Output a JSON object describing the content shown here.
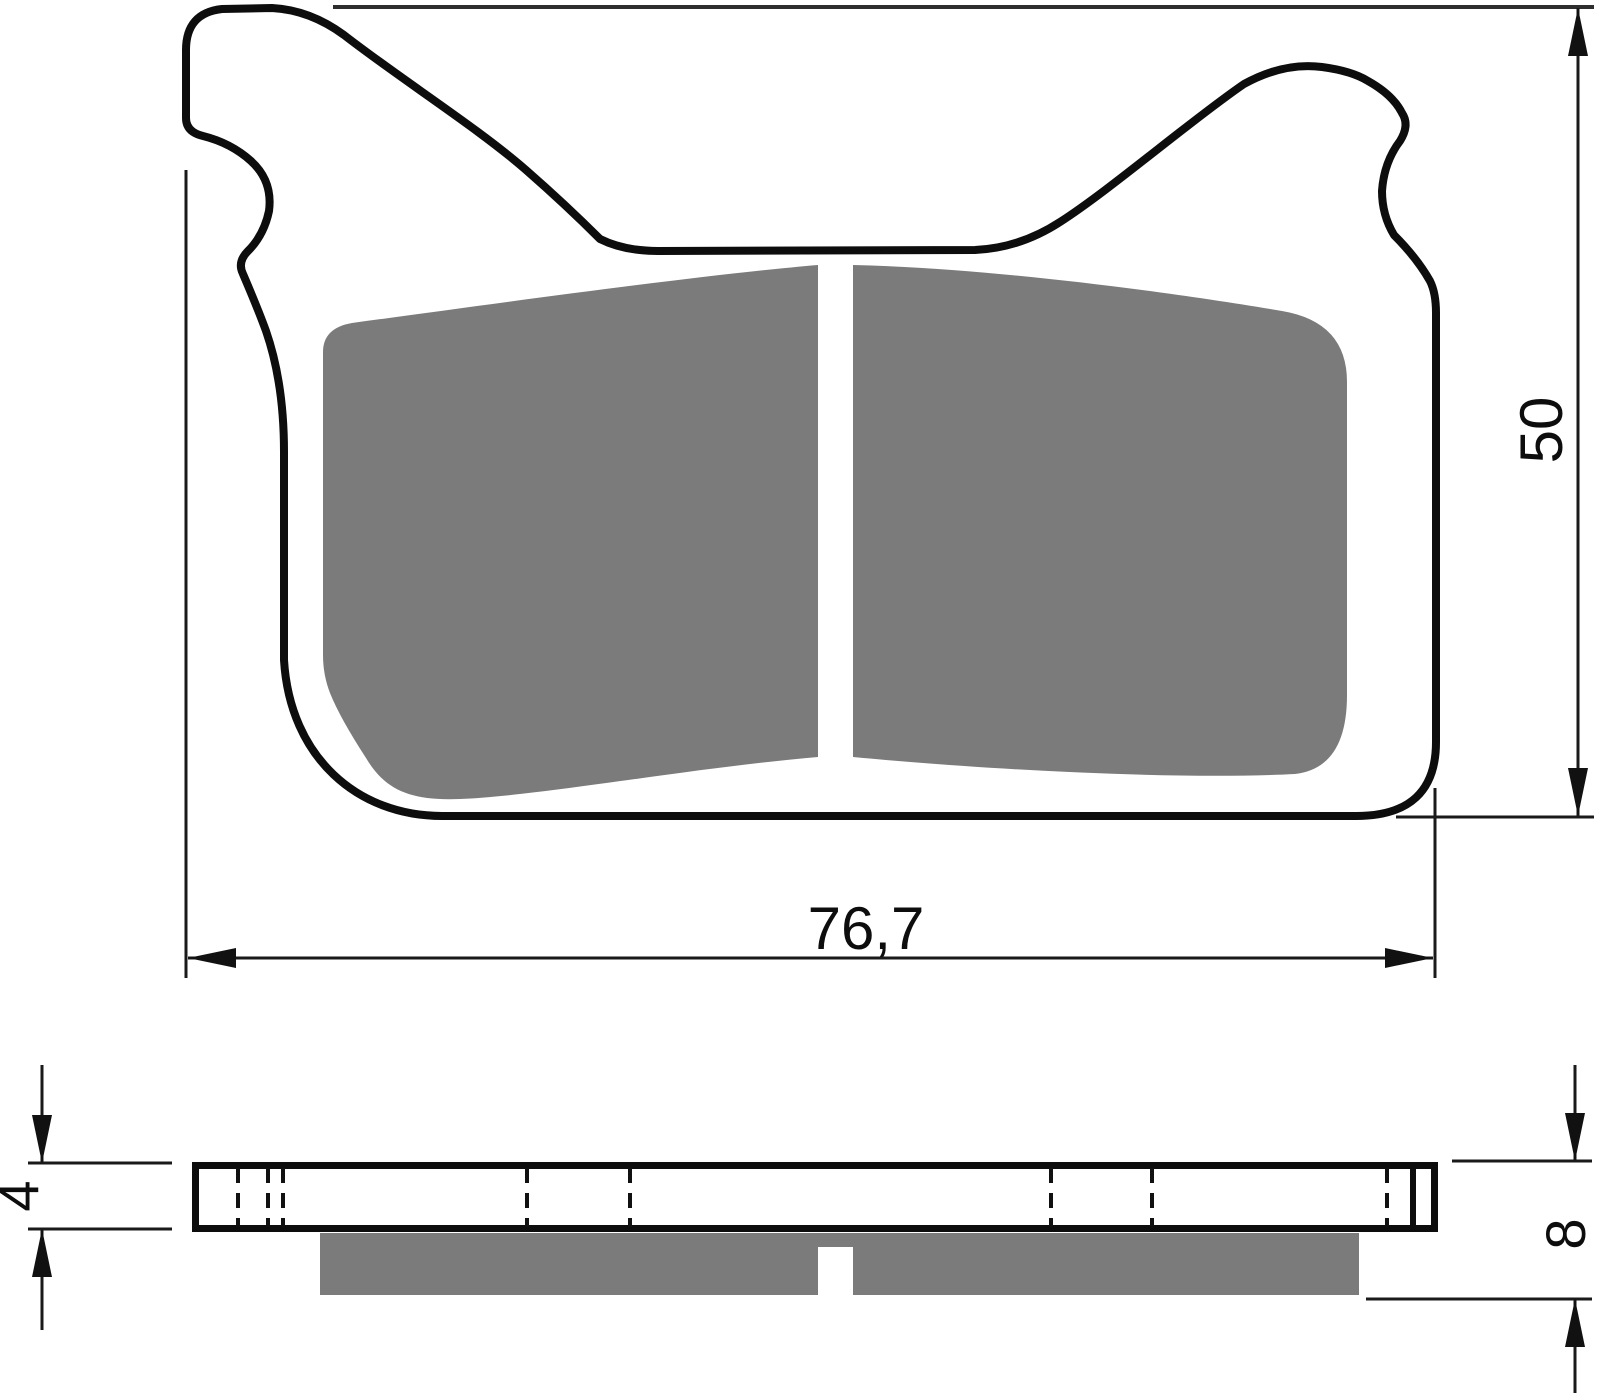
{
  "drawing": {
    "kind": "technical-drawing",
    "dimensions": {
      "width": {
        "label": "76,7"
      },
      "height": {
        "label": "50"
      },
      "backing_plate_thickness": {
        "label": "4"
      },
      "total_thickness": {
        "label": "8"
      }
    },
    "colors": {
      "line": "#0d0d0d",
      "friction": "#7b7b7b",
      "extension_line": "#2e2e2e",
      "background": "#ffffff"
    }
  }
}
